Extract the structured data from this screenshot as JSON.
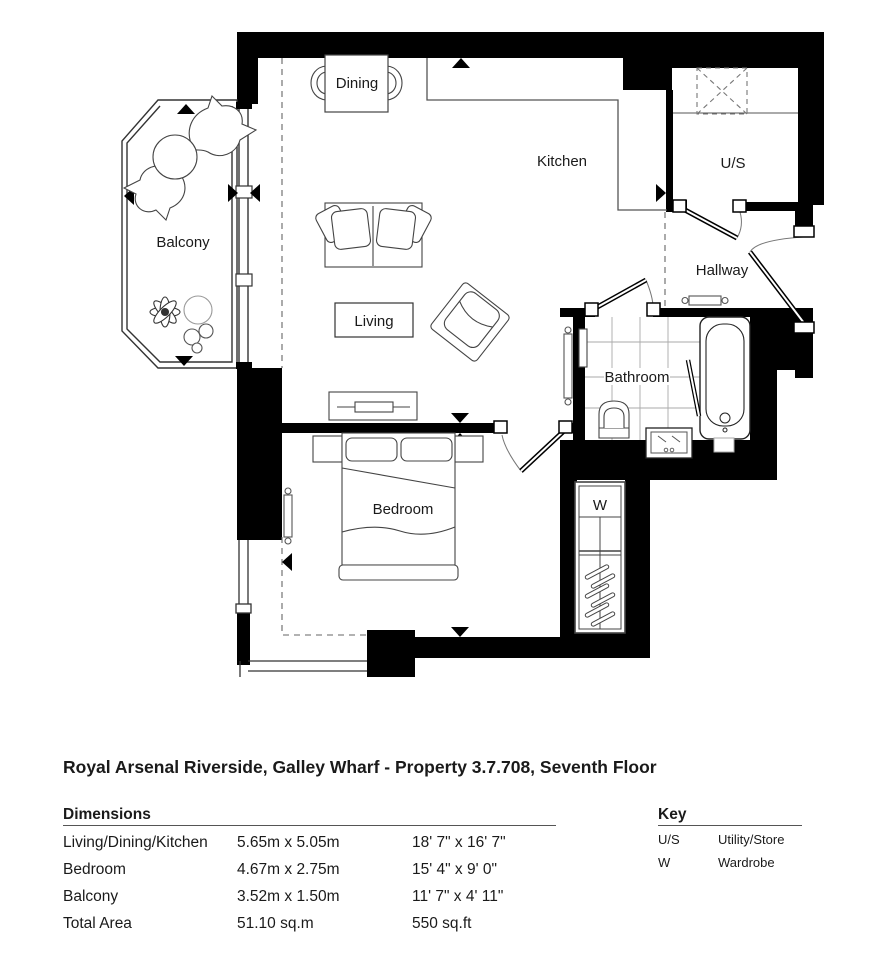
{
  "title": "Royal Arsenal Riverside, Galley Wharf - Property 3.7.708, Seventh Floor",
  "plan": {
    "labels": {
      "dining": "Dining",
      "kitchen": "Kitchen",
      "utility": "U/S",
      "hallway": "Hallway",
      "balcony": "Balcony",
      "living": "Living",
      "bathroom": "Bathroom",
      "bedroom": "Bedroom",
      "wardrobe": "W"
    }
  },
  "dimensions": {
    "heading": "Dimensions",
    "rows": [
      {
        "name": "Living/Dining/Kitchen",
        "metric": "5.65m x 5.05m",
        "imperial": "18' 7\" x 16' 7\""
      },
      {
        "name": "Bedroom",
        "metric": "4.67m x 2.75m",
        "imperial": "15' 4\" x 9' 0\""
      },
      {
        "name": "Balcony",
        "metric": "3.52m x 1.50m",
        "imperial": "11' 7\" x 4' 11\""
      },
      {
        "name": "Total Area",
        "metric": "51.10 sq.m",
        "imperial": "550 sq.ft"
      }
    ]
  },
  "key": {
    "heading": "Key",
    "rows": [
      {
        "abbr": "U/S",
        "meaning": "Utility/Store"
      },
      {
        "abbr": "W",
        "meaning": "Wardrobe"
      }
    ]
  },
  "colors": {
    "wall": "#000000",
    "furniture_line": "#444444",
    "tile_grid": "#999999"
  }
}
